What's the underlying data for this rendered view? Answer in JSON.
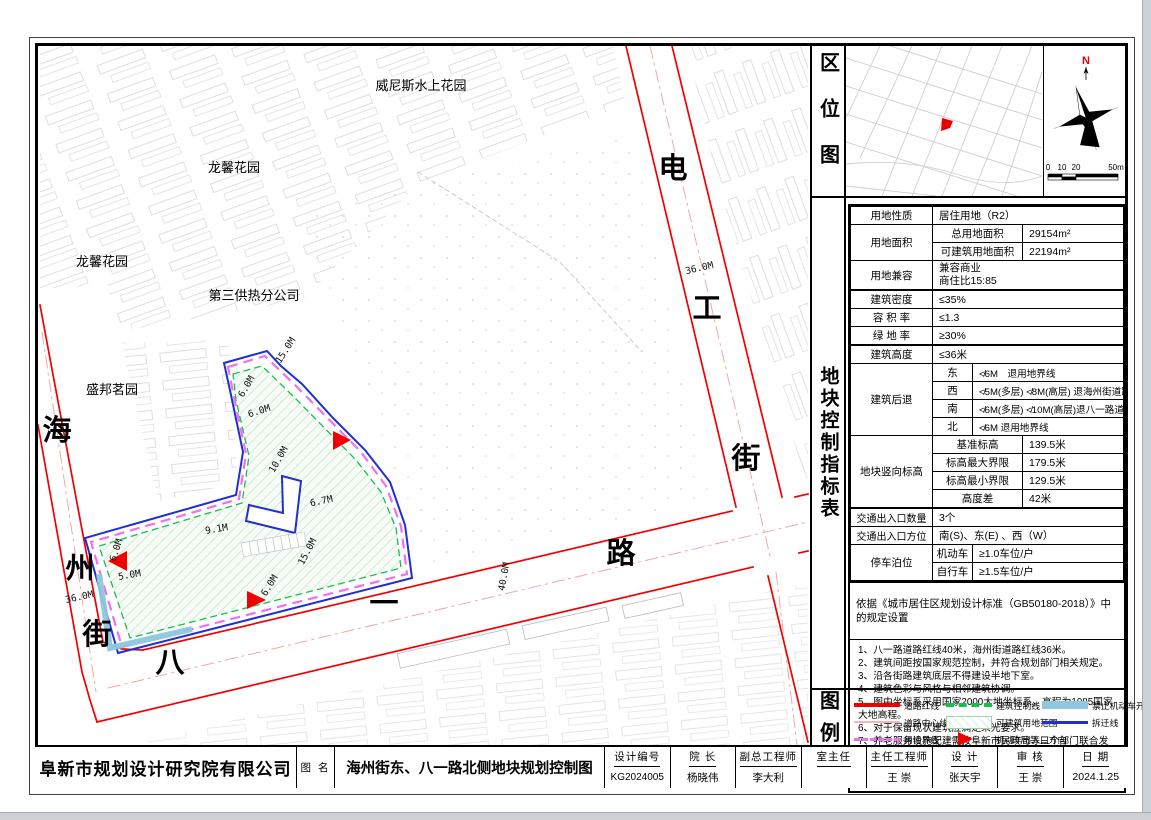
{
  "sections": {
    "location": "区位图",
    "indicators": "地块控制指标表",
    "legend": "图例"
  },
  "location_map": {
    "north": "N",
    "scale": [
      "0",
      "10",
      "20",
      "50m"
    ]
  },
  "table": {
    "land_use_label": "用地性质",
    "land_use": "居住用地（R2）",
    "area_label": "用地面积",
    "total_area_label": "总用地面积",
    "total_area": "29154m²",
    "buildable_area_label": "可建筑用地面积",
    "buildable_area": "22194m²",
    "mix_label": "用地兼容",
    "mix_line1": "兼容商业",
    "mix_line2": "商住比15:85",
    "density_label": "建筑密度",
    "density": "≤35%",
    "far_label": "容 积 率",
    "far": "≤1.3",
    "green_label": "绿 地 率",
    "green": "≥30%",
    "height_label": "建筑高度",
    "height": "≤36米",
    "setback_label": "建筑后退",
    "setbacks": [
      {
        "dir": "东",
        "text": "≮6M　退用地界线"
      },
      {
        "dir": "西",
        "text": "≮5M(多层) ≮8M(高层) 退海州街道路红线"
      },
      {
        "dir": "南",
        "text": "≮6M(多层) ≮10M(高层)退八一路道路红线"
      },
      {
        "dir": "北",
        "text": "≮6M 退用地界线"
      }
    ],
    "elevation_label": "地块竖向标高",
    "elevations": [
      {
        "k": "基准标高",
        "v": "139.5米"
      },
      {
        "k": "标高最大界限",
        "v": "179.5米"
      },
      {
        "k": "标高最小界限",
        "v": "129.5米"
      },
      {
        "k": "高度差",
        "v": "42米"
      }
    ],
    "entrance_count_label": "交通出入口数量",
    "entrance_count": "3个",
    "entrance_dir_label": "交通出入口方位",
    "entrance_dir": "南(S)、东(E) 、西（W）",
    "parking_label": "停车泊位",
    "parking": [
      {
        "k": "机动车",
        "v": "≥1.0车位/户"
      },
      {
        "k": "自行车",
        "v": "≥1.5车位/户"
      }
    ],
    "standard_note": "依据《城市居住区规划设计标准（GB50180-2018）》中的规定设置"
  },
  "notes": [
    "1、八一路道路红线40米，海州街道路红线36米。",
    "2、建筑间距按国家规范控制，并符合规划部门相关规定。",
    "3、沿各街路建筑底层不得建设半地下室。",
    "4、建筑色彩与风格与相邻建筑协调。",
    "5、图中坐标系采用国家2000大地坐标系，高程为1985国家大地高程。",
    "6、对于保留现状建筑应满足采光要求。",
    "7、养老服务设施配建需按阜新市民政局等三个部门联合发布的《<关于做好社区居家养老服务设施配建和管理工作的通知>(2022年1月11日)》执行。配建的养老服务设施套内建筑面积应不低于小区总建筑面积的2%。"
  ],
  "legend": {
    "items": [
      {
        "label": "道路红线"
      },
      {
        "label": "建筑控制线"
      },
      {
        "label": "禁止机动车开口路段"
      },
      {
        "label": "道路中心线"
      },
      {
        "label": "可建筑用地范围"
      },
      {
        "label": "拆迁线"
      },
      {
        "label": "用地界线"
      },
      {
        "label": "机动车出入口方向"
      }
    ]
  },
  "map": {
    "areas": {
      "a1": "威尼斯水上花园",
      "a2": "龙馨花园",
      "a3": "龙馨花园",
      "a4": "第三供热分公司",
      "a5": "盛邦茗园"
    },
    "streets": {
      "haizhou": [
        "海",
        "州",
        "街"
      ],
      "bayi": [
        "八",
        "一",
        "路"
      ],
      "diangong": [
        "电",
        "工",
        "街"
      ]
    },
    "dims": {
      "haizhou_w": "36.0M",
      "bayi_w": "40.0M",
      "diangong_w": "36.0M",
      "top": "15.0M",
      "nw1": "6.0M",
      "nw2": "6.0M",
      "arm": "10.0M",
      "mid": "6.7M",
      "inner": "9.1M",
      "east": "15.0M",
      "south": "6.0M",
      "west": "6.0M",
      "sw": "5.0M"
    }
  },
  "titleblock": {
    "company": "阜新市规划设计研究院有限公司",
    "drawing_name_label": "图 名",
    "drawing_name": "海州街东、八一路北侧地块规划控制图",
    "fields": [
      {
        "label": "设计编号",
        "value": "KG2024005"
      },
      {
        "label": "院 长",
        "value": "杨晓伟"
      },
      {
        "label": "副总工程师",
        "value": "李大利"
      },
      {
        "label": "室主任",
        "value": ""
      },
      {
        "label": "主任工程师",
        "value": "王 崇"
      },
      {
        "label": "设 计",
        "value": "张天宇"
      },
      {
        "label": "审 核",
        "value": "王 崇"
      },
      {
        "label": "日 期",
        "value": "2024.1.25"
      }
    ]
  }
}
